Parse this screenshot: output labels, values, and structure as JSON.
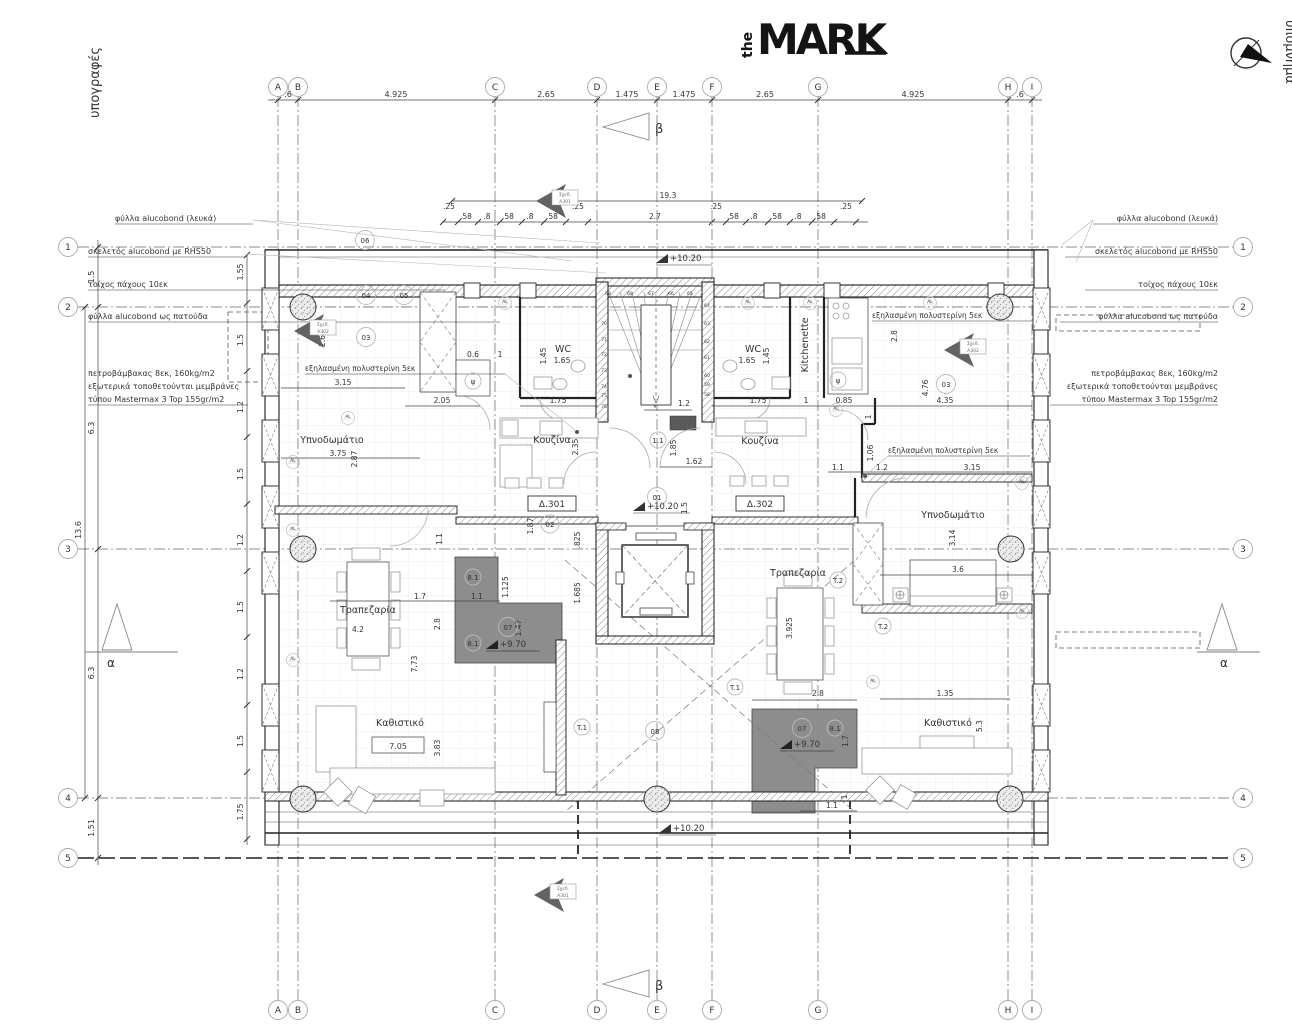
{
  "logo": {
    "prefix": "the",
    "name": "MARK"
  },
  "margins": {
    "left": "υπογραφές",
    "right": "υπόμνημα"
  },
  "grid": {
    "columns": [
      "A",
      "B",
      "C",
      "D",
      "E",
      "F",
      "G",
      "H",
      "I"
    ],
    "column_dims": [
      ".6",
      "4.925",
      "2.65",
      "1.475",
      "1.475",
      "2.65",
      "4.925",
      ".6"
    ],
    "rows": [
      "1",
      "2",
      "3",
      "4",
      "5"
    ],
    "row_dims": [
      "1.5",
      "6.3",
      "6.3",
      "1.51"
    ],
    "row_total": "13.6"
  },
  "updims": {
    "total": "19.3",
    "mid": "2.7",
    "seq": [
      ".25",
      ".58",
      ".8",
      ".58",
      ".8",
      ".58",
      ".25"
    ]
  },
  "leftwall": [
    "1.55",
    "1.5",
    "1.2",
    "1.5",
    "1.2",
    "1.5",
    "1.2",
    "1.5",
    "1.75"
  ],
  "notes": {
    "alucobond_white": "φύλλα alucobond (λευκά)",
    "skeleton": "σκελετός alucobond με RHS50",
    "wall10": "τοίχος πάχους 10εκ",
    "alucobond_sill": "φύλλα alucobond ως πατούδα",
    "rockwool": "πετροβάμβακας 8εκ, 160kg/m2",
    "membranes": "εξωτερικά τοποθετούνται μεμβράνες",
    "mastermax": "τύπου Mastermax 3 Top 155gr/m2",
    "polystyrene": "εξηλασμένη πολυστερίνη 5εκ"
  },
  "levels": {
    "main": "+10.20",
    "terrace": "+9.70"
  },
  "units": {
    "left": "Δ.301",
    "right": "Δ.302"
  },
  "rooms": {
    "bedroom": "Υπνοδωμάτιο",
    "kitchen": "Κουζίνα",
    "wc": "WC",
    "kitchenette": "Kitchenette",
    "dining": "Τραπεζαρία",
    "living": "Καθιστικό"
  },
  "tags": {
    "t1": "T.1",
    "t2": "T.2",
    "al": "AL",
    "n01": "01",
    "n02": "02",
    "n03": "03",
    "n04": "04",
    "n05": "05",
    "n06": "06",
    "n07": "07",
    "n08": "08",
    "n81": "8.1",
    "n11": "1.1",
    "psi": "ψ",
    "alpha": "α",
    "beta": "β"
  },
  "refs": {
    "sched": "Σχεδ.",
    "a301": "A301",
    "a302": "A302"
  },
  "dims": {
    "d315": "3.15",
    "d205": "2.05",
    "d06": "0.6",
    "d1": "1",
    "d175": "1.75",
    "d26": "2.6",
    "d12": "1.2",
    "d185": "1.85",
    "d162": "1.62",
    "d085": "0.85",
    "d28": "2.8",
    "d476": "4.76",
    "d435": "4.35",
    "d106": "1.06",
    "d11": "1.1",
    "d375": "3.75",
    "d287": "2.87",
    "d235": "2.35",
    "d165": "1.65",
    "d145": "1.45",
    "d42": "4.2",
    "d17": "1.7",
    "d1125": "1.125",
    "d147": "1.47",
    "d1685": "1.685",
    "d187": "1.87",
    "d825": ".825",
    "d705": "7.05",
    "d773": "7.73",
    "d383": "3.83",
    "d3925": "3.925",
    "d36": "3.6",
    "d314": "3.14",
    "d53": "5.3",
    "d135": "1.35",
    "d15": "1.5"
  },
  "stairs": {
    "treads_top": [
      "69",
      "68",
      "67",
      "66",
      "65"
    ],
    "treads_left": [
      "70",
      "71",
      "72",
      "73",
      "74",
      "75",
      "76"
    ],
    "treads_right": [
      "64",
      "63",
      "62",
      "61",
      "60",
      "59",
      "58"
    ]
  }
}
